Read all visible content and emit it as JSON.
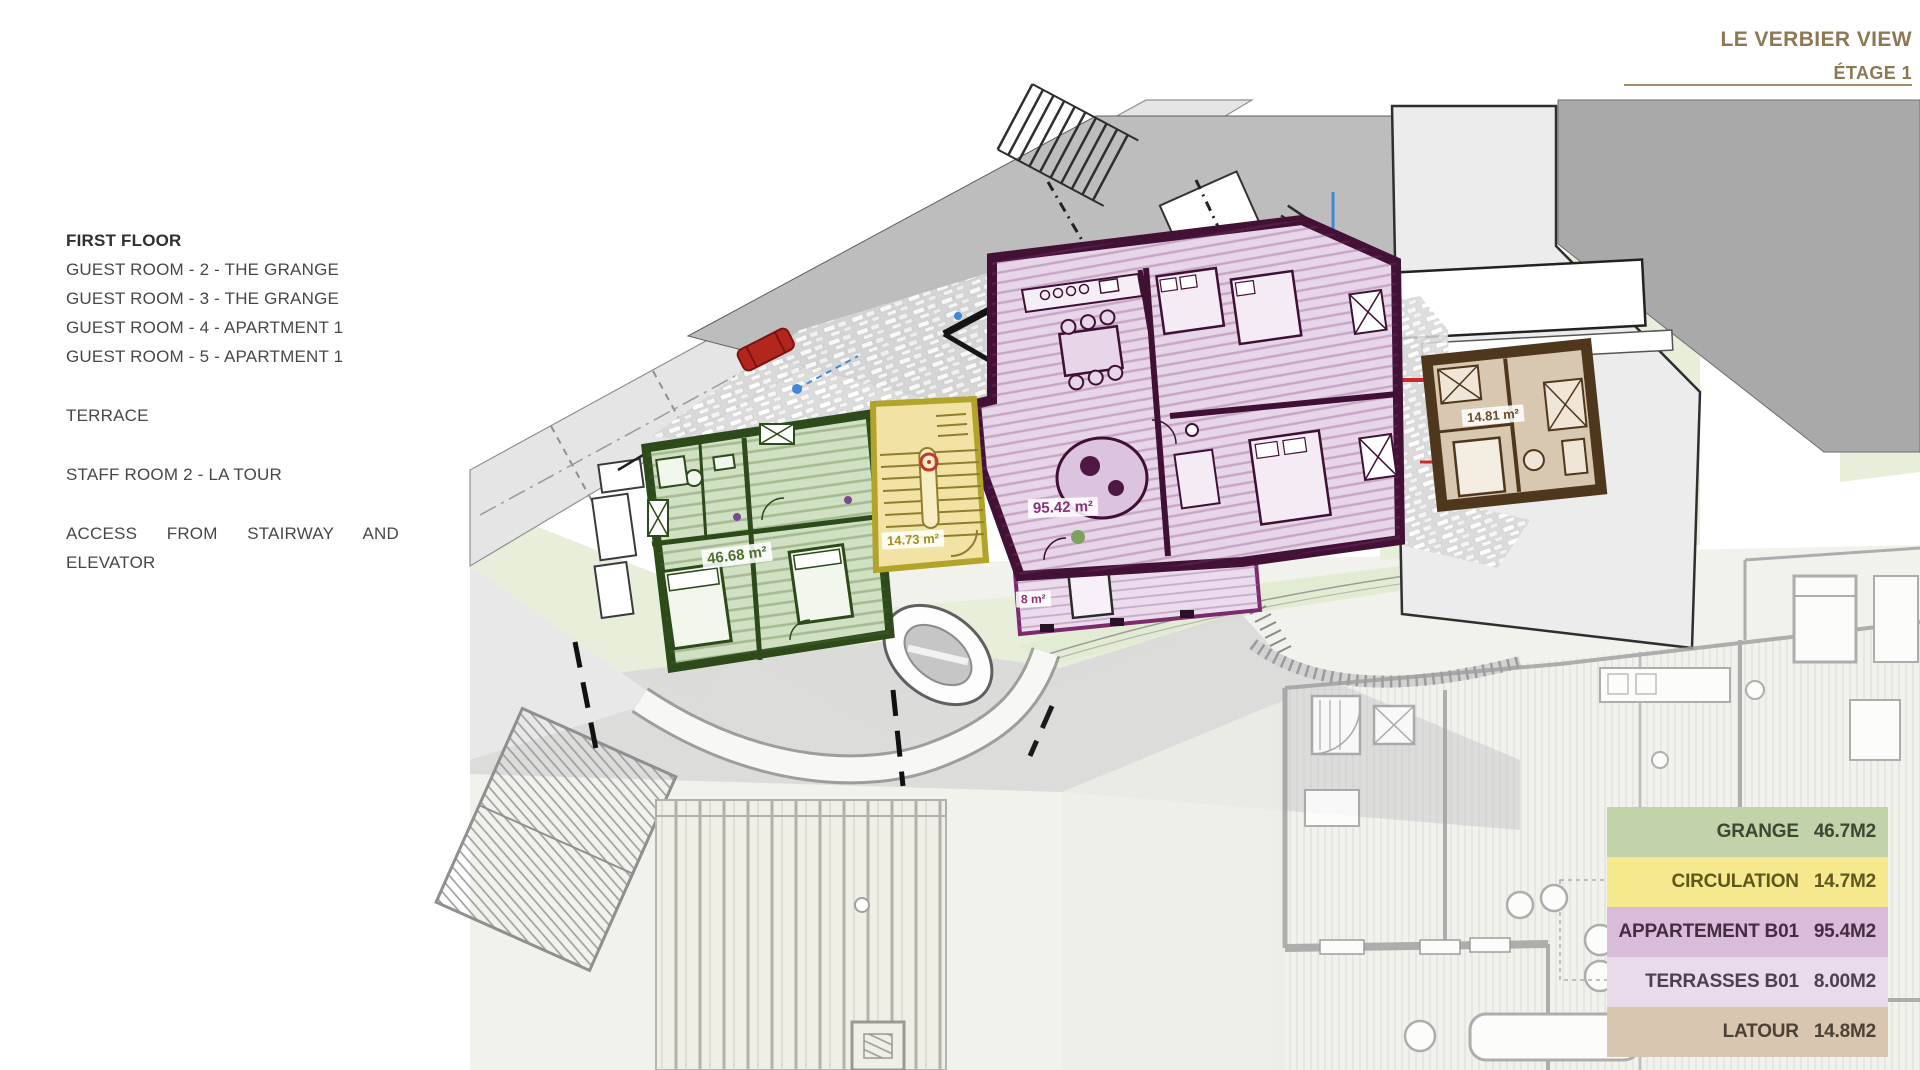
{
  "title": {
    "project": "LE VERBIER VIEW",
    "floor": "ÉTAGE 1"
  },
  "info_panel": {
    "heading": "FIRST FLOOR",
    "rooms": [
      "GUEST ROOM - 2 - THE GRANGE",
      "GUEST ROOM - 3 - THE GRANGE",
      "GUEST ROOM - 4 - APARTMENT 1",
      "GUEST ROOM - 5 - APARTMENT 1"
    ],
    "terrace": "TERRACE",
    "staff": "STAFF ROOM 2 - LA TOUR",
    "access_line1": "ACCESS FROM STAIRWAY AND",
    "access_line2": "ELEVATOR"
  },
  "plan_labels": {
    "grange_area": "46.68 m²",
    "circulation_area": "14.73 m²",
    "apartment_area": "95.42 m²",
    "terrace_area": "8 m²",
    "tour_area": "14.81 m²"
  },
  "legend": {
    "rows": [
      {
        "label": "GRANGE",
        "value": "46.7M2",
        "color": "#c2d3aa"
      },
      {
        "label": "CIRCULATION",
        "value": "14.7M2",
        "color": "#f6e98d"
      },
      {
        "label": "APPARTEMENT B01",
        "value": "95.4M2",
        "color": "#d9bcd9"
      },
      {
        "label": "TERRASSES B01",
        "value": "8.00M2",
        "color": "#e9dcea"
      },
      {
        "label": "LATOUR",
        "value": "14.8M2",
        "color": "#d8c6b0"
      }
    ]
  },
  "colors": {
    "title_bronze": "#8c7852",
    "grange_fill": "#d0e0c2",
    "grange_border": "#2c4a1a",
    "circulation_fill": "#f2e3a4",
    "circulation_border": "#b2a32a",
    "apartment_fill": "#e7d5e8",
    "apartment_border": "#441136",
    "terrace_fill": "#eadcec",
    "terrace_border": "#7c2a6e",
    "tour_fill": "#d9c8b1",
    "tour_border": "#4e371c"
  }
}
